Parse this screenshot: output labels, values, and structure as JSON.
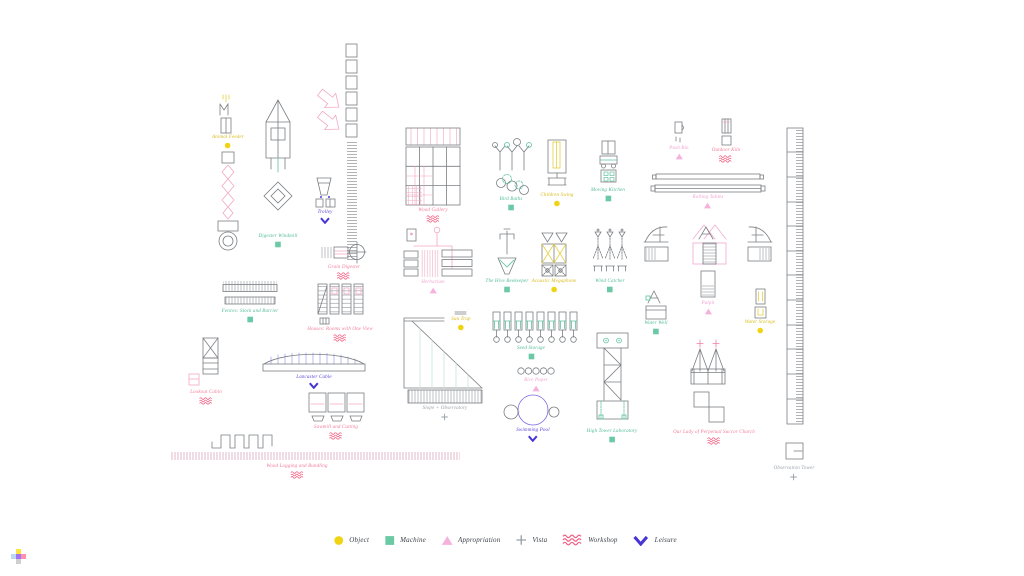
{
  "canvas": {
    "width": 1024,
    "height": 576,
    "background": "#ffffff"
  },
  "colors": {
    "ink": "#7b7e82",
    "pink_line": "#f2a9c4",
    "teal_line": "#5fc2a0",
    "yellow_line": "#e3cf3e",
    "blue_line": "#7a68e0"
  },
  "categories": {
    "object": {
      "label": "Object",
      "marker": "dot",
      "color": "#f0d414",
      "text_color": "#d9bb1d"
    },
    "machine": {
      "label": "Machine",
      "marker": "square",
      "color": "#6cc9a6",
      "text_color": "#53bb98"
    },
    "appropriation": {
      "label": "Appropriation",
      "marker": "triangle",
      "color": "#f4b2dd",
      "text_color": "#f0a3d0"
    },
    "vista": {
      "label": "Vista",
      "marker": "plus",
      "color": "#99a0a6",
      "text_color": "#9ba1a7"
    },
    "workshop": {
      "label": "Workshop",
      "marker": "zigzag",
      "color": "#f25f82",
      "text_color": "#f27e9a"
    },
    "leisure": {
      "label": "Leisure",
      "marker": "chevron",
      "color": "#4836d4",
      "text_color": "#5b48d8"
    }
  },
  "legend": {
    "order": [
      "object",
      "machine",
      "appropriation",
      "vista",
      "workshop",
      "leisure"
    ]
  },
  "items": [
    {
      "id": "animal-feeder",
      "label": "Animal Feeder",
      "category": "object",
      "x": 228,
      "y": 135
    },
    {
      "id": "digester-windmill",
      "label": "Digester Windmill",
      "category": "machine",
      "x": 278,
      "y": 234
    },
    {
      "id": "trolley",
      "label": "Trolley",
      "category": "leisure",
      "x": 325,
      "y": 210
    },
    {
      "id": "grain-digester",
      "label": "Grain Digester",
      "category": "workshop",
      "x": 344,
      "y": 265
    },
    {
      "id": "fences",
      "label": "Fences: Stock and Barrier",
      "category": "machine",
      "x": 250,
      "y": 309
    },
    {
      "id": "houses-one-view",
      "label": "Houses: Rooms with One View",
      "category": "workshop",
      "x": 340,
      "y": 327
    },
    {
      "id": "lookout-cabin",
      "label": "Lookout Cabin",
      "category": "workshop",
      "x": 206,
      "y": 390
    },
    {
      "id": "lancaster-cable",
      "label": "Lancaster Cable",
      "category": "leisure",
      "x": 314,
      "y": 375
    },
    {
      "id": "sawmill",
      "label": "Sawmill and Cutting",
      "category": "workshop",
      "x": 336,
      "y": 425
    },
    {
      "id": "wood-logging",
      "label": "Wood Logging and Bundling",
      "category": "workshop",
      "x": 297,
      "y": 464
    },
    {
      "id": "wood-gallery",
      "label": "Wood Gallery",
      "category": "workshop",
      "x": 433,
      "y": 208
    },
    {
      "id": "herbarium",
      "label": "Herbarium",
      "category": "appropriation",
      "x": 433,
      "y": 280
    },
    {
      "id": "bird-baths",
      "label": "Bird Baths",
      "category": "machine",
      "x": 511,
      "y": 197
    },
    {
      "id": "children-swing",
      "label": "Children Swing",
      "category": "object",
      "x": 557,
      "y": 193
    },
    {
      "id": "moving-kitchen",
      "label": "Moving Kitchen",
      "category": "machine",
      "x": 608,
      "y": 188
    },
    {
      "id": "push-bin",
      "label": "Push Bin",
      "category": "appropriation",
      "x": 679,
      "y": 146
    },
    {
      "id": "kiln",
      "label": "Outdoor Kiln",
      "category": "workshop",
      "x": 726,
      "y": 148
    },
    {
      "id": "rolling-tables",
      "label": "Rolling Tables",
      "category": "appropriation",
      "x": 708,
      "y": 195
    },
    {
      "id": "hive-beekeeper",
      "label": "The Hive Beekeeper",
      "category": "machine",
      "x": 507,
      "y": 279
    },
    {
      "id": "acoustic-megaphone",
      "label": "Acoustic Megaphone",
      "category": "object",
      "x": 554,
      "y": 279
    },
    {
      "id": "wind-catcher",
      "label": "Wind Catcher",
      "category": "machine",
      "x": 610,
      "y": 279
    },
    {
      "id": "pulpit",
      "label": "Pulpit",
      "category": "appropriation",
      "x": 708,
      "y": 301
    },
    {
      "id": "water-well",
      "label": "Water Well",
      "category": "machine",
      "x": 656,
      "y": 321
    },
    {
      "id": "water-storage",
      "label": "Water Storage",
      "category": "object",
      "x": 760,
      "y": 320
    },
    {
      "id": "seed-storage",
      "label": "Seed Storage",
      "category": "machine",
      "x": 531,
      "y": 346
    },
    {
      "id": "sun-trap",
      "label": "Sun Trap",
      "category": "object",
      "x": 461,
      "y": 317
    },
    {
      "id": "slope-observatory",
      "label": "Slope + Observatory",
      "category": "vista",
      "x": 445,
      "y": 406
    },
    {
      "id": "rice-paper",
      "label": "Rice Paper",
      "category": "appropriation",
      "x": 536,
      "y": 378
    },
    {
      "id": "swimming-pool",
      "label": "Swimming Pool",
      "category": "leisure",
      "x": 533,
      "y": 428
    },
    {
      "id": "high-tower-laboratory",
      "label": "High Tower Laboratory",
      "category": "machine",
      "x": 612,
      "y": 429
    },
    {
      "id": "church",
      "label": "Our Lady of Perpetual Succor Church",
      "category": "workshop",
      "x": 714,
      "y": 430
    },
    {
      "id": "observation-tower",
      "label": "Observation Tower",
      "category": "vista",
      "x": 794,
      "y": 466
    }
  ]
}
